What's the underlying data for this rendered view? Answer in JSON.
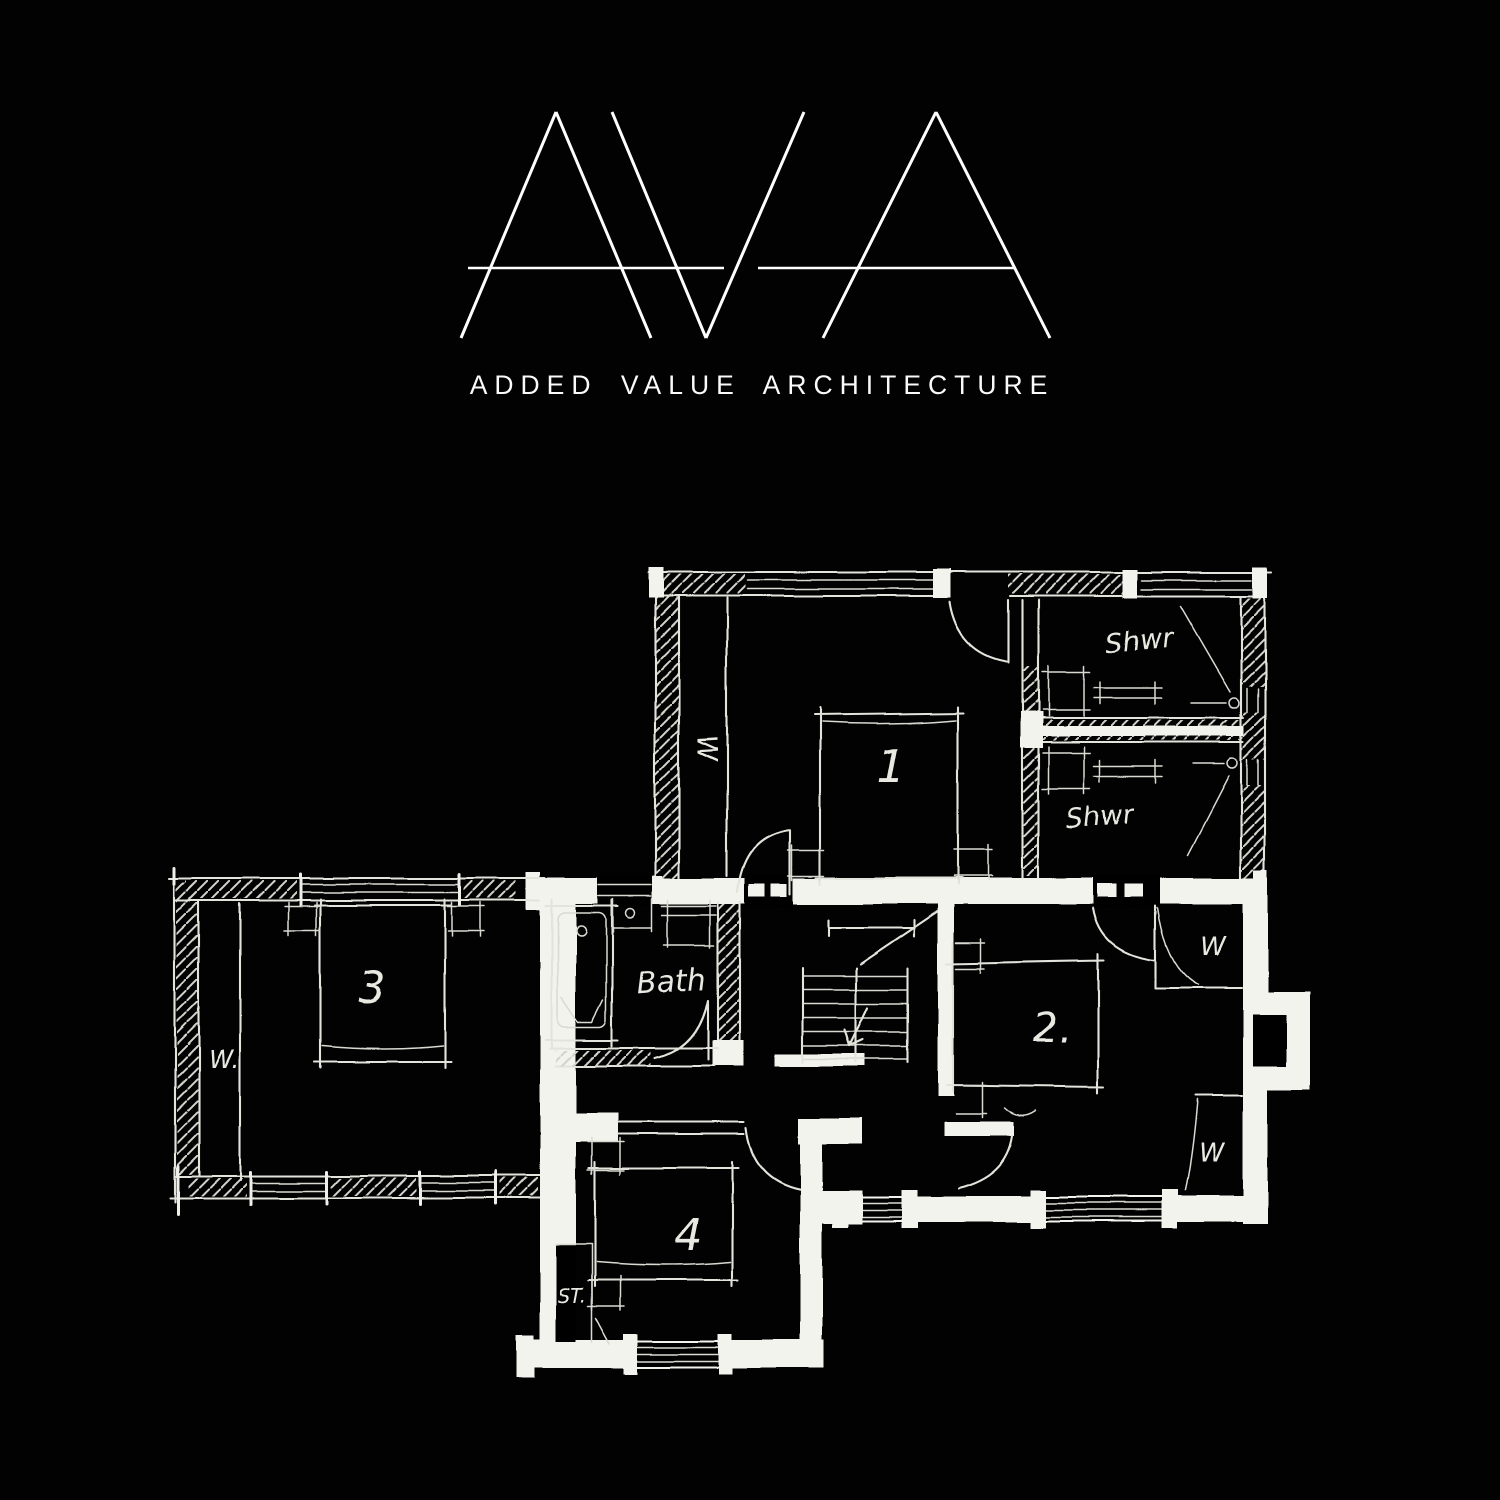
{
  "page": {
    "background": "#000000"
  },
  "logo": {
    "monogram": "AVA",
    "tagline": "ADDED VALUE ARCHITECTURE",
    "color": "#ffffff"
  },
  "plan": {
    "ink_color": "#e3e3dc",
    "marker_color": "#f3f3ee",
    "labels": {
      "bedroom1": "1",
      "bedroom2": "2.",
      "bedroom3": "3",
      "bedroom4": "4",
      "bath": "Bath",
      "shwr_top": "Shwr",
      "shwr_bottom": "Shwr",
      "closet_bed1": "W",
      "wardrobe_bed3": "W.",
      "wardrobe_right_top": "W",
      "wardrobe_right_bottom": "W",
      "storage": "ST."
    }
  }
}
